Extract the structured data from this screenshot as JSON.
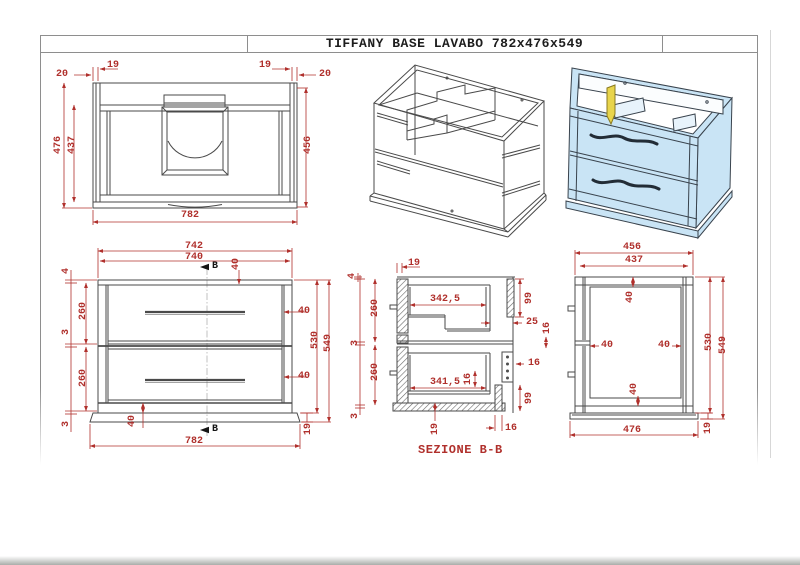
{
  "title_block": {
    "title": "TIFFANY BASE LAVABO 782x476x549"
  },
  "colors": {
    "dimension_red": "#b0302c",
    "line_dark": "#4a4a4a",
    "cabinet_blue": "#c9e4f5",
    "interior_blue": "#e8f3fb",
    "accent_yellow": "#e8d44b",
    "frame_gray": "#8e8e8e"
  },
  "views": {
    "top_view": {
      "dims": {
        "tl20": "20",
        "tl19": "19",
        "tr19": "19",
        "tr20": "20",
        "d476": "476",
        "d437": "437",
        "d456": "456",
        "w782": "782"
      }
    },
    "front_view": {
      "section_marker_top": "B",
      "section_marker_bottom": "B",
      "dims": {
        "w742": "742",
        "w740": "740",
        "t40": "40",
        "l4": "4",
        "l260a": "260",
        "l3a": "3",
        "l260b": "260",
        "l3b": "3",
        "r40a": "40",
        "r40b": "40",
        "h530": "530",
        "h549": "549",
        "b40": "40",
        "w782": "782",
        "b19": "19"
      }
    },
    "section_view": {
      "caption": "SEZIONE B-B",
      "dims": {
        "t4": "4",
        "t19": "19",
        "l260a": "260",
        "l3a": "3",
        "l260b": "260",
        "l3b": "3",
        "d342": "342,5",
        "r99a": "99",
        "r25": "25",
        "r16_edge": "16",
        "r16_rail": "16",
        "i16": "16",
        "d341": "341,5",
        "r99b": "99",
        "b19": "19",
        "b16": "16"
      }
    },
    "side_view": {
      "dims": {
        "w456": "456",
        "w437": "437",
        "t40": "40",
        "l40": "40",
        "r40": "40",
        "h530": "530",
        "h549": "549",
        "b40": "40",
        "w476": "476",
        "b19": "19"
      }
    }
  }
}
